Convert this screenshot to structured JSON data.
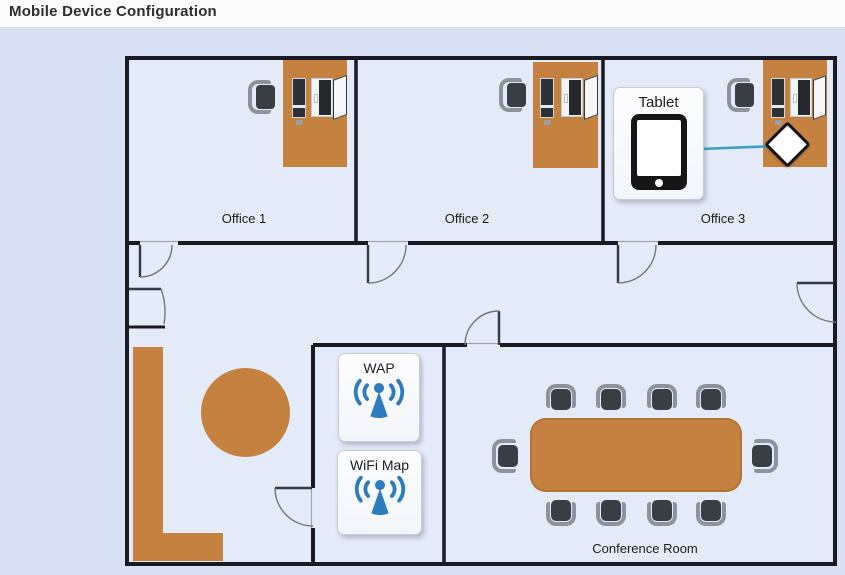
{
  "header": {
    "title": "Mobile Device Configuration"
  },
  "floor_plan": {
    "rooms": [
      {
        "id": "office-1",
        "label": "Office 1"
      },
      {
        "id": "office-2",
        "label": "Office 2"
      },
      {
        "id": "office-3",
        "label": "Office 3"
      },
      {
        "id": "conference-room",
        "label": "Conference Room"
      }
    ],
    "devices": [
      {
        "id": "tablet",
        "label": "Tablet",
        "icon": "tablet-icon"
      },
      {
        "id": "wap",
        "label": "WAP",
        "icon": "wifi-antenna-icon"
      },
      {
        "id": "wifi-map",
        "label": "WiFi Map",
        "icon": "wifi-antenna-icon"
      },
      {
        "id": "wap-location-marker",
        "icon": "diamond-marker"
      }
    ],
    "colors": {
      "furniture_orange": "#c5813f",
      "wall": "#1a1a24",
      "device_icon_blue": "#2b7dc0",
      "connector_teal": "#3aa2c0",
      "floor_inside": "#e3eaf8",
      "floor_outside": "#d8e1f3",
      "chair_seat": "#383e44",
      "chair_arm": "#8b939c"
    }
  }
}
